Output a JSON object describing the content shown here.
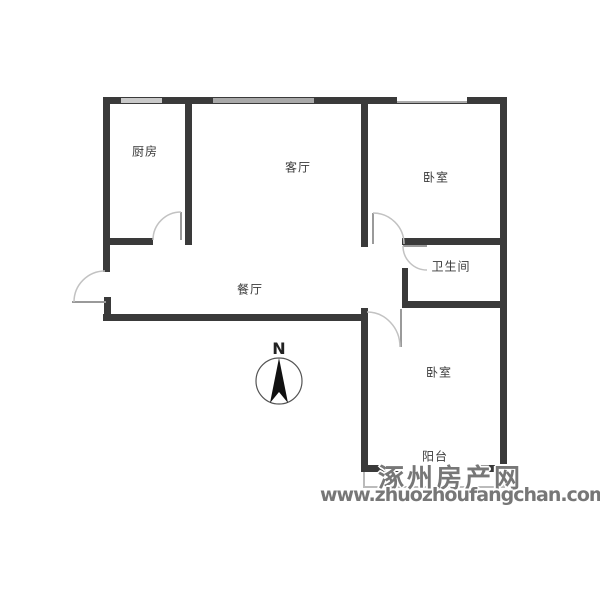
{
  "plan": {
    "rooms": [
      {
        "id": "kitchen",
        "label": "厨房"
      },
      {
        "id": "living-room",
        "label": "客厅"
      },
      {
        "id": "bedroom-top",
        "label": "卧室"
      },
      {
        "id": "dining-room",
        "label": "餐厅"
      },
      {
        "id": "bathroom",
        "label": "卫生间"
      },
      {
        "id": "bedroom-bottom",
        "label": "卧室"
      },
      {
        "id": "balcony",
        "label": "阳台"
      }
    ],
    "compass": {
      "label": "N"
    },
    "colors": {
      "wall": "#3a3a3a",
      "window_light": "#c9c9c9",
      "window_mid": "#a9a9a9",
      "thin_line": "#bbbbbb",
      "door_arc": "#c2c2c2",
      "watermark": "#777777",
      "background": "#ffffff"
    }
  },
  "watermark": {
    "site_name": "涿州房产网",
    "site_url": "www.zhuozhoufangchan.com"
  }
}
